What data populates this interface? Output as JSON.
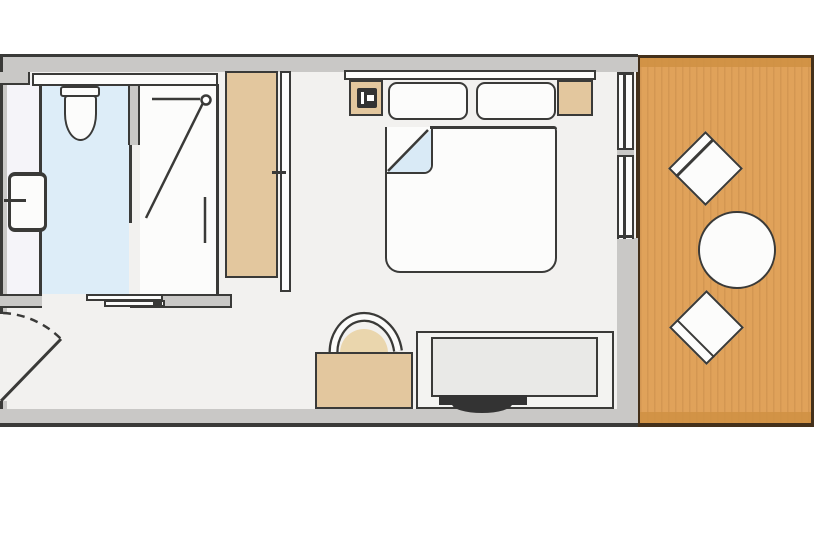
{
  "document": {
    "kind": "floor-plan",
    "description": "Top-down architectural floor plan of a hotel guest room with en-suite bathroom, bedroom and wooden terrace",
    "visible_text": "none"
  },
  "colors": {
    "line": "#3a3a38",
    "wall": "#c9c8c6",
    "floor": "#f2f1ef",
    "bath-blue": "#ddedf8",
    "vanity": "#f5f4f9",
    "wood": "#e0a25a",
    "wood-band": "#cf9143",
    "wood-border": "#44301a",
    "tan": "#e3c79e",
    "fixture": "#fcfcfb",
    "sheet": "#d9eaf6",
    "desk-inner": "#e9e9e7",
    "tv": "#333333",
    "dome": "#ead6ad"
  },
  "rooms": [
    {
      "name": "bathroom",
      "floor": "light-blue wet floor with white vanity and shower zones",
      "fixtures": [
        "counter-shelf",
        "toilet",
        "washbasin-with-faucet",
        "walk-in-shower-with-pivot-door",
        "sliding-entry-door"
      ]
    },
    {
      "name": "bedroom",
      "floor": "light-grey",
      "fixtures": [
        "wardrobe",
        "wardrobe-door",
        "headboard",
        "nightstand-left-with-telephone",
        "nightstand-right",
        "double-bed-with-two-pillows",
        "folded-duvet-corner",
        "armchair-with-round-back",
        "tv-console",
        "flat-screen-tv",
        "hinged-entry-door-with-swing-arc",
        "sliding-glass-window"
      ]
    },
    {
      "name": "terrace",
      "floor": "wood-deck",
      "fixtures": [
        "deck-chair-upper",
        "round-table",
        "deck-chair-lower"
      ]
    }
  ]
}
